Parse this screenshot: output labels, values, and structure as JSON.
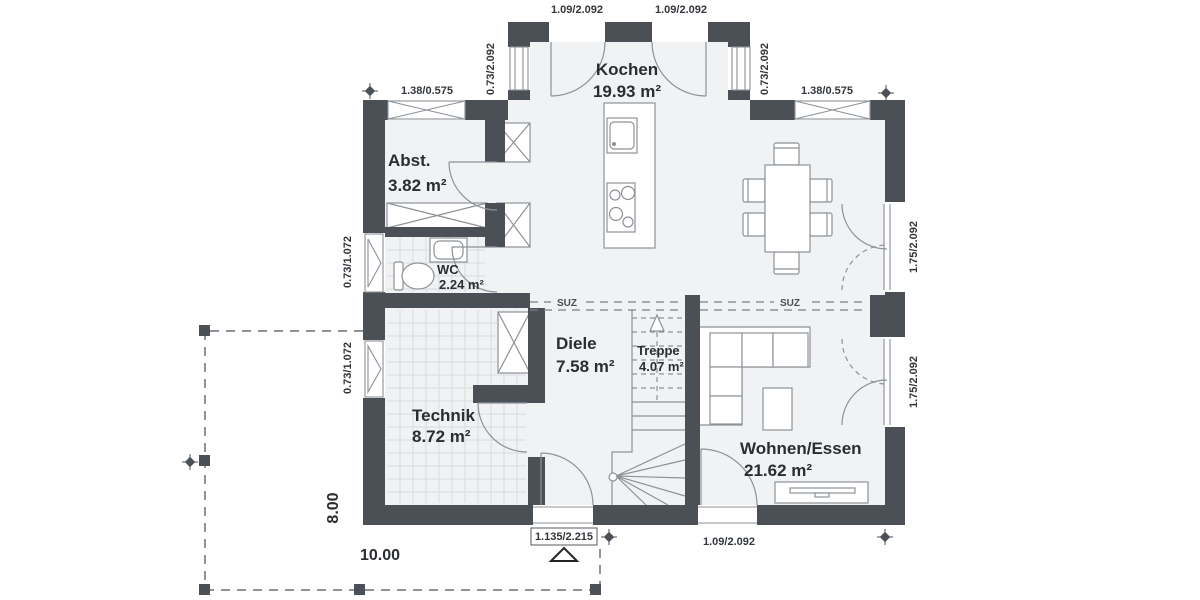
{
  "colors": {
    "wall": "#4b5056",
    "line": "#8d9298",
    "tile": "#d8dbde",
    "text": "#2a2d31"
  },
  "rooms": {
    "kochen": {
      "name": "Kochen",
      "area": "19.93 m²"
    },
    "abst": {
      "name": "Abst.",
      "area": "3.82 m²"
    },
    "wc": {
      "name": "WC",
      "area": "2.24 m²"
    },
    "diele": {
      "name": "Diele",
      "area": "7.58 m²"
    },
    "treppe": {
      "name": "Treppe",
      "area": "4.07 m²"
    },
    "technik": {
      "name": "Technik",
      "area": "8.72 m²"
    },
    "wohnen": {
      "name": "Wohnen/Essen",
      "area": "21.62 m²"
    }
  },
  "dimensions": {
    "top_door_left": "1.09/2.092",
    "top_door_right": "1.09/2.092",
    "bump_window_left": "0.73/2.092",
    "bump_window_right": "0.73/2.092",
    "north_window_left": "1.38/0.575",
    "north_window_right": "1.38/0.575",
    "west_window_wc": "0.73/1.072",
    "west_window_technik": "0.73/1.072",
    "east_door_upper": "1.75/2.092",
    "east_door_lower": "1.75/2.092",
    "entry_door": "1.135/2.215",
    "south_door": "1.09/2.092",
    "building_width": "10.00",
    "building_depth": "8.00"
  },
  "annotations": {
    "lintel_left": "SUZ",
    "lintel_right": "SUZ"
  }
}
